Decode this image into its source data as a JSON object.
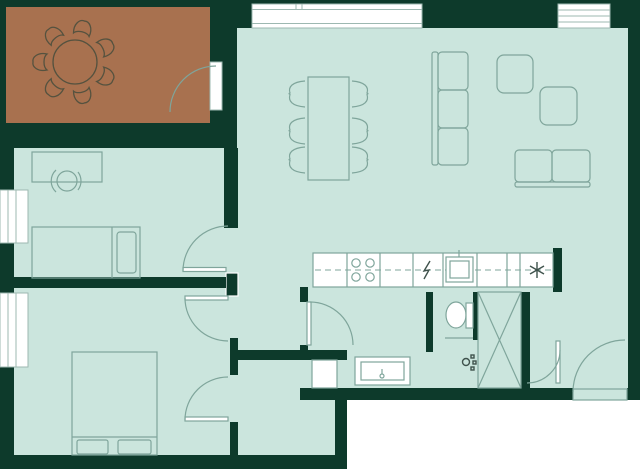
{
  "title": "apartment-floor-plan",
  "canvas": {
    "width": 640,
    "height": 472
  },
  "colors": {
    "background": "#ffffff",
    "wall": "#0d3a2b",
    "floor": "#cbe5dd",
    "terrace": "#a8714f",
    "line": "#7fa59b",
    "terraceLine": "#55523f",
    "frame": "#9db8b1",
    "symbol": "#3f524c"
  },
  "rooms": [
    {
      "id": "terrace",
      "note": "brown outdoor terrace, round table with 7 chairs, top-left"
    },
    {
      "id": "living-dining-room",
      "note": "large room top-right with dining table, 6 chairs, 3-seat sofa, 2 armchairs, 2-seat sofa"
    },
    {
      "id": "bedroom-1",
      "note": "left middle, desk with chair and single bed"
    },
    {
      "id": "bedroom-2",
      "note": "bottom-left, double bed with two pillows"
    },
    {
      "id": "walk-in-closet",
      "note": "small room right of bedroom 2"
    },
    {
      "id": "kitchen",
      "note": "counter strip with cooktop, dishwasher symbol, sink, freezer symbol"
    },
    {
      "id": "bathroom",
      "note": "toilet, shower fitting, vanity basin, washing machine, x-marked shaft"
    },
    {
      "id": "entry-hall",
      "note": "bottom-right with entrance door arc"
    }
  ],
  "fixtures": [
    "round-terrace-table",
    "terrace-chairs",
    "dining-table",
    "dining-chairs",
    "sofa-3-seat",
    "armchair",
    "armchair",
    "sofa-2-seat",
    "desk",
    "desk-chair",
    "single-bed",
    "double-bed",
    "cooktop-4-burner",
    "dishwasher-symbol",
    "kitchen-sink",
    "freezer-symbol",
    "toilet",
    "shower-fitting",
    "vanity-basin",
    "washing-machine",
    "shaft-x-box"
  ],
  "windows": [
    {
      "id": "window-top-large",
      "x": 252,
      "y": 4,
      "w": 170,
      "h": 24
    },
    {
      "id": "window-top-right",
      "x": 558,
      "y": 4,
      "w": 52,
      "h": 24
    },
    {
      "id": "window-left-bedroom-1",
      "x": 0,
      "y": 190,
      "w": 28,
      "h": 53
    },
    {
      "id": "window-left-bedroom-2",
      "x": 0,
      "y": 293,
      "w": 28,
      "h": 74
    }
  ],
  "doors": [
    "terrace-door",
    "bedroom-1-door",
    "bedroom-2-door",
    "closet-door",
    "bathroom-door-west",
    "bathroom-door-east",
    "entrance-door"
  ]
}
